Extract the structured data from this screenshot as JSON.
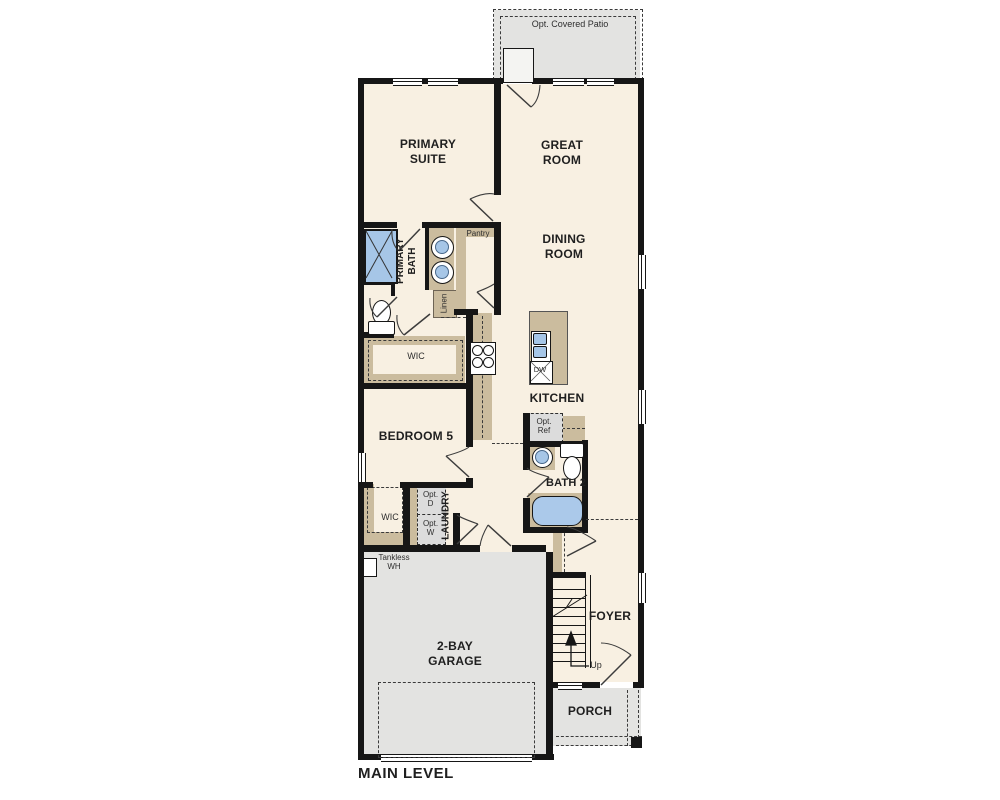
{
  "plan": {
    "title": "MAIN LEVEL",
    "labels": {
      "patio": "Opt. Covered Patio",
      "primary_suite": "PRIMARY SUITE",
      "great_room": "GREAT ROOM",
      "dining_room": "DINING ROOM",
      "primary_bath": "PRIMARY BATH",
      "pantry": "Pantry",
      "linen": "Linen",
      "wic_primary": "WIC",
      "kitchen": "KITCHEN",
      "dw": "DW",
      "opt_ref": "Opt. Ref",
      "bedroom5": "BEDROOM 5",
      "bath2": "BATH 2",
      "wic_bedroom5": "WIC",
      "laundry": "LAUNDRY",
      "opt_d": "Opt. D",
      "opt_w": "Opt. W",
      "tankless_wh": "Tankless WH",
      "garage": "2-BAY GARAGE",
      "foyer": "FOYER",
      "up": "Up",
      "porch": "PORCH"
    },
    "colors": {
      "wall": "#161616",
      "floor": "#f8f0e2",
      "cabinet": "#cbbc9e",
      "concrete": "#e3e3e1",
      "fixture_blue": "#a6c6e7",
      "optional_fill": "#dcdcdc"
    }
  }
}
